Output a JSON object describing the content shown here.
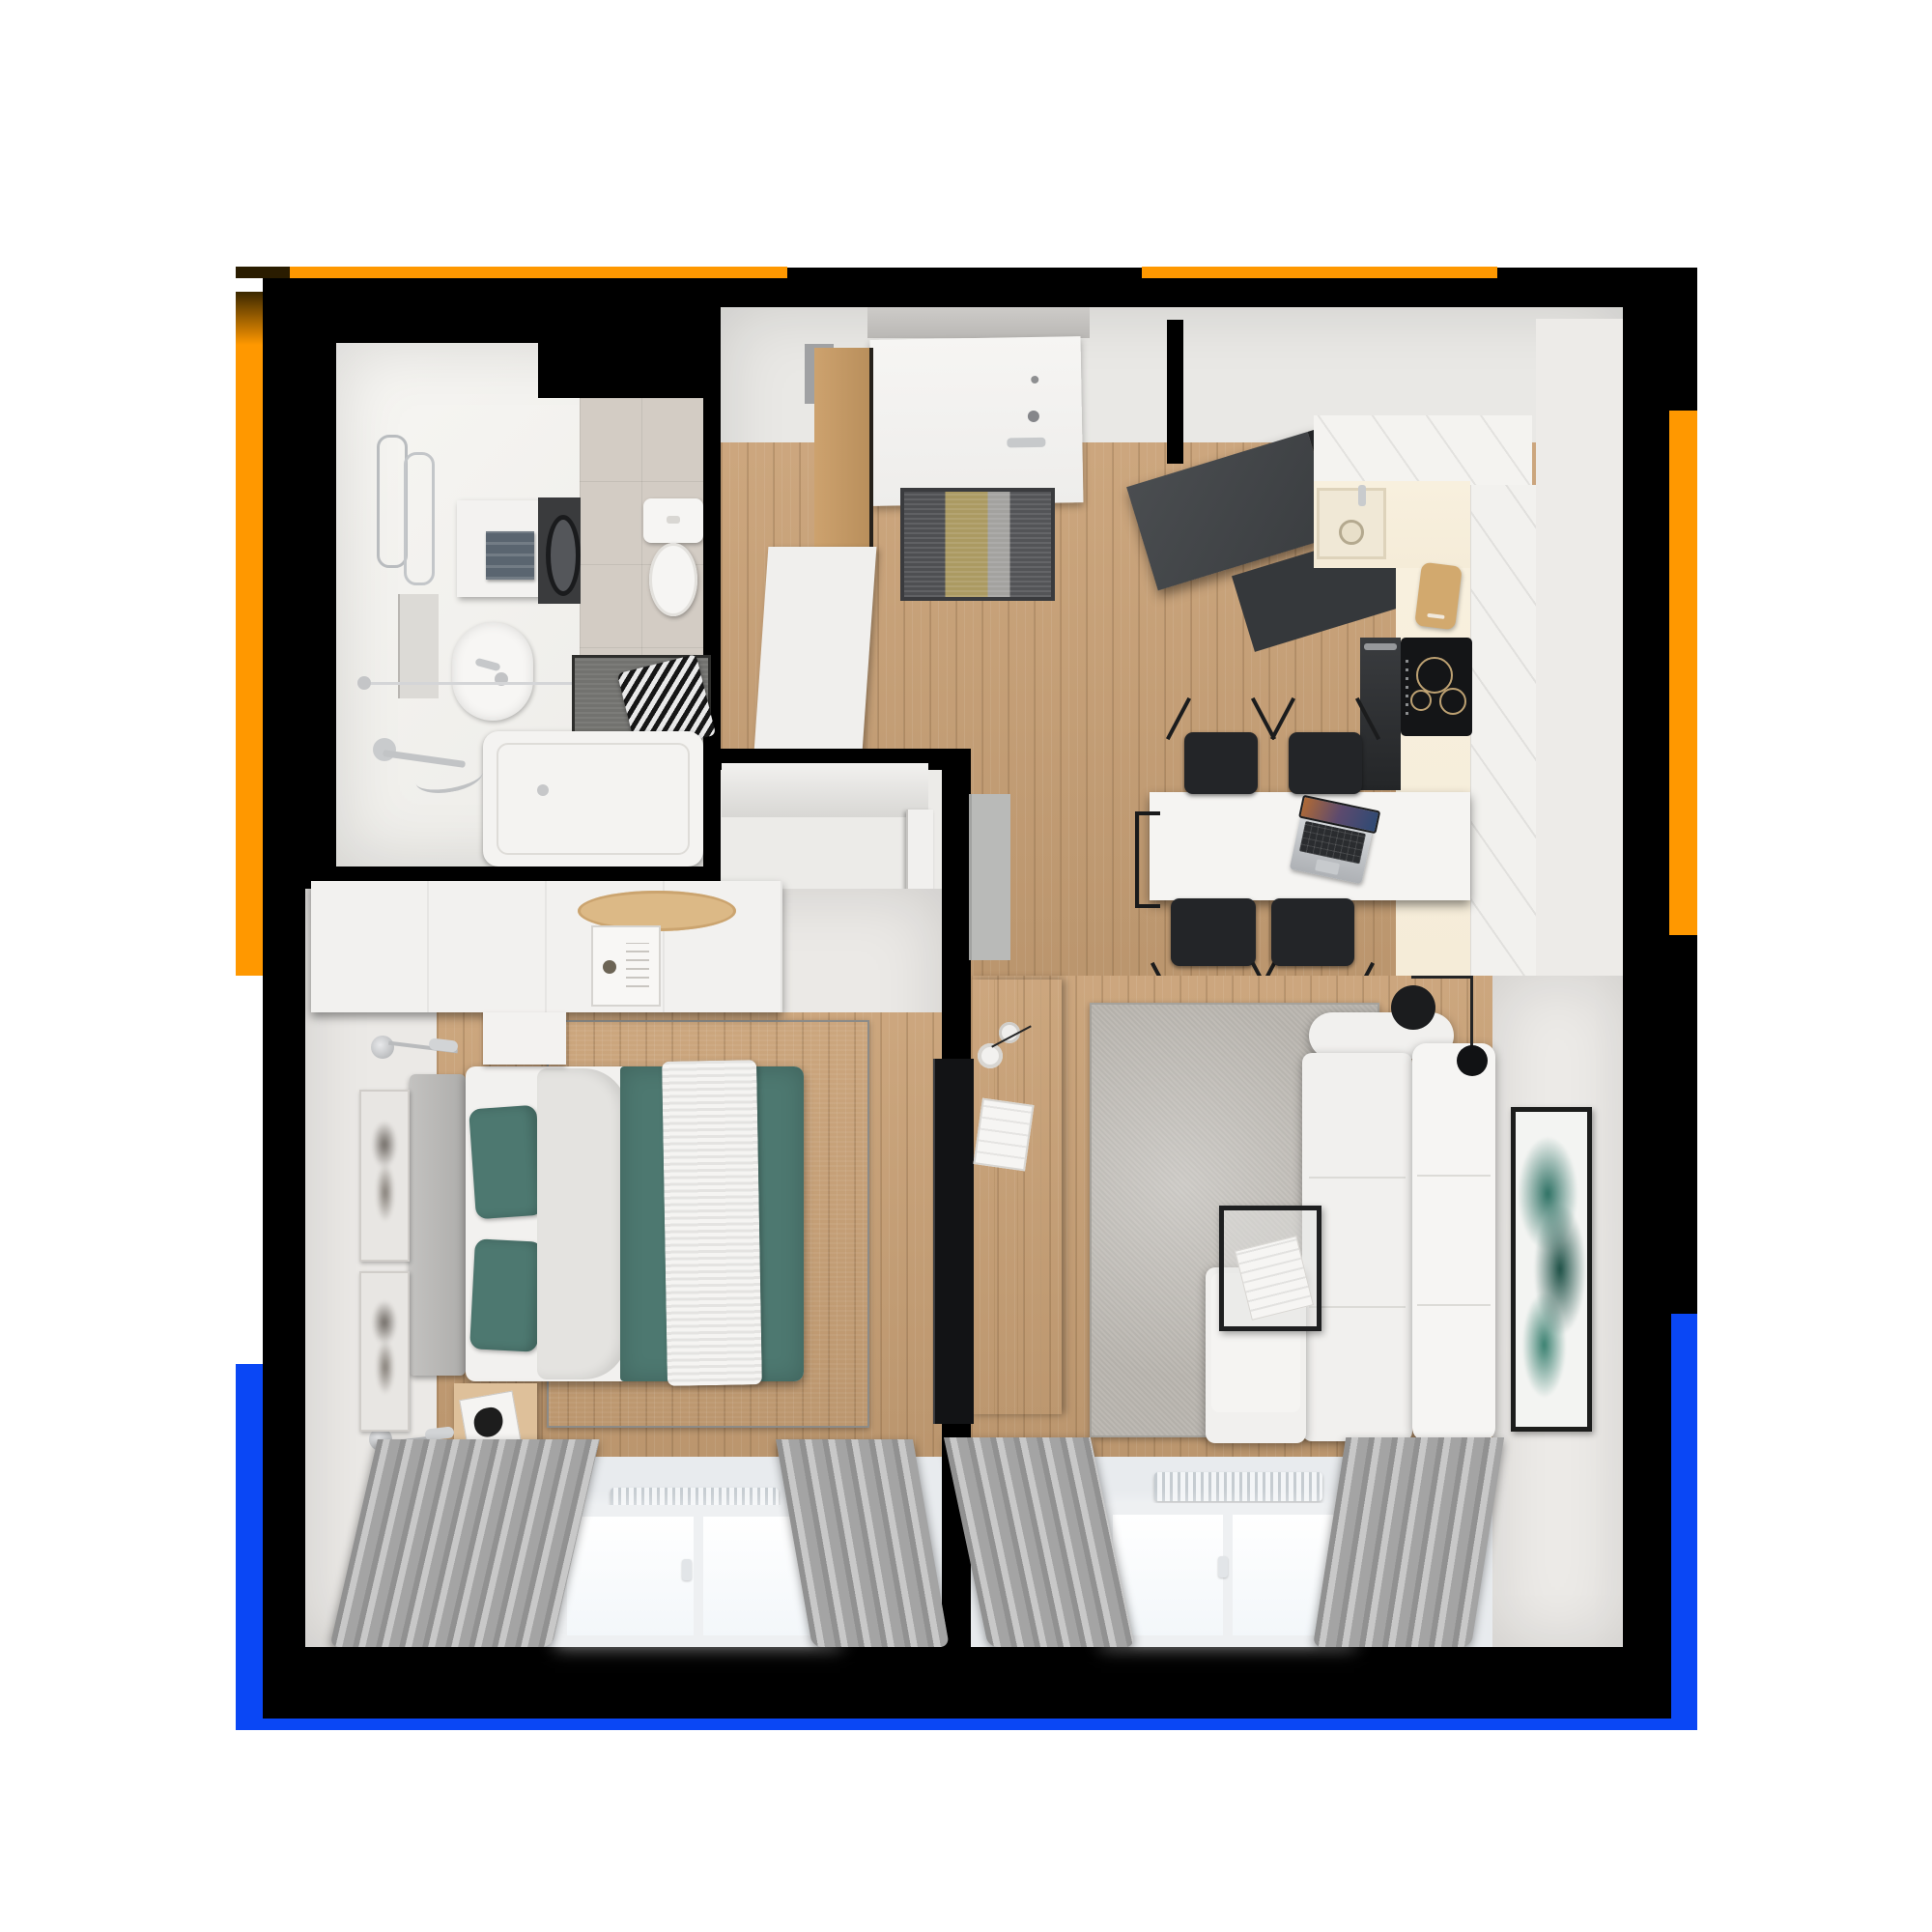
{
  "page": {
    "title": "Apartment 3D floor plan — top-down render",
    "view": "top-down-3d-render"
  },
  "colors": {
    "page_bg": "#ffffff",
    "plan_bg": "#000000",
    "accent_orange": "#ff9800",
    "accent_orange_dark": "#2a1c00",
    "accent_blue": "#0a47f5",
    "wall_white": "#e9e8e5",
    "floor_wood": "#c9a176",
    "tile_gray": "#d3ccc4",
    "counter_cream": "#f5ecd8",
    "textile_teal": "#4d7870",
    "sofa_white": "#f1f0ee",
    "rug_bedroom": "#a5a4a1",
    "rug_living": "#bdb9b3",
    "console_wood": "#e0cda6",
    "unit_dark": "#3a3d40",
    "appliance_black": "#141517",
    "curtain_gray": "#a9a9a9",
    "doormat_khaki": "#ab9a62",
    "art_green": "#2e7164"
  },
  "frame": {
    "segments": [
      "top-left orange line",
      "top-right orange line",
      "left orange bar",
      "right orange bar",
      "left blue bar",
      "right blue bar",
      "bottom blue line"
    ]
  },
  "rooms": {
    "bathroom": {
      "label": "Bathroom",
      "items": [
        "towel rails",
        "storage cabinet",
        "folded towel",
        "washing machine",
        "toilet",
        "washbasin",
        "mirror",
        "shower rod",
        "bath mat",
        "striped towels",
        "bathtub",
        "shower mixer"
      ]
    },
    "hallway": {
      "label": "Entry hallway",
      "items": [
        "entry door",
        "striped doormat",
        "wardrobe",
        "shoe cabinet"
      ]
    },
    "kitchen": {
      "label": "Kitchen and dining",
      "items": [
        "tall dark unit",
        "upper cabinets",
        "sink",
        "cream counter",
        "oven",
        "induction cooktop",
        "cutting board",
        "dining table",
        "laptop",
        "four folding chairs"
      ]
    },
    "bedroom": {
      "label": "Bedroom",
      "items": [
        "dresser",
        "wooden tray",
        "decor box",
        "double bed",
        "teal pillows",
        "teal bedspread",
        "knit throw",
        "gray rug",
        "nightstands",
        "magazine",
        "wall lamps",
        "two art prints",
        "window",
        "radiator",
        "curtains"
      ]
    },
    "living_room": {
      "label": "Living room",
      "items": [
        "media console",
        "TV",
        "coffee cups",
        "magazine file",
        "corner sofa",
        "wire coffee table",
        "magazine",
        "floor lamp",
        "gray rug",
        "green abstract art",
        "window",
        "radiator",
        "curtains"
      ]
    }
  }
}
